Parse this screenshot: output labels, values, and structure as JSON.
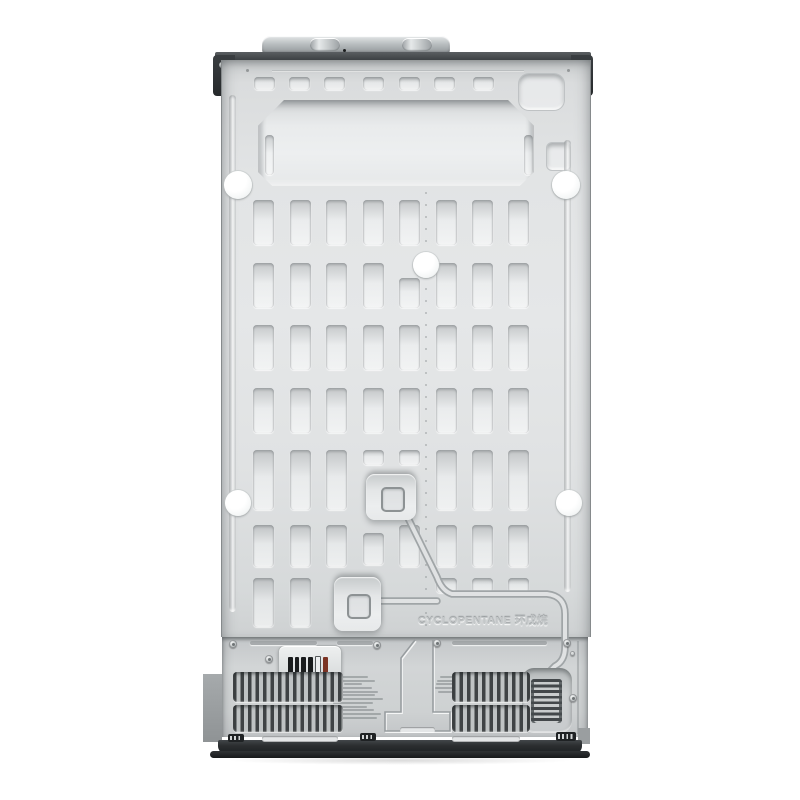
{
  "product": {
    "description": "Rear view photo of a side-by-side refrigerator back panel",
    "embossed_text": "CYCLOPENTANE 环戊烷"
  },
  "colors": {
    "background": "#ffffff",
    "panel_gray": "#e2e4e5",
    "bottom_panel_gray": "#ced1d2",
    "top_bar_dark": "#3c4043",
    "bracket_dark": "#26292b",
    "base_black": "#1d2022",
    "plug_white": "#ffffff",
    "grille_dark": "#3f4345",
    "label_bar_black": "#1a1c1d",
    "label_bar_red": "#7c3424"
  },
  "decor": {
    "top_slots": {
      "y": 77,
      "h": 13,
      "w": 21,
      "xs": [
        253,
        288,
        323,
        362,
        398,
        433,
        472
      ]
    },
    "vent_grid": {
      "xs": [
        252,
        289,
        325,
        362,
        398,
        435,
        471,
        507
      ],
      "w": 21,
      "variants": {
        "s": {
          "dy": 0,
          "h": 15
        },
        "l": {
          "dy": 15,
          "h": 30
        },
        "m": {
          "dy": 8,
          "h": 32
        }
      },
      "rows": [
        {
          "y": 200,
          "h": 45,
          "cols": [
            1,
            1,
            1,
            1,
            1,
            1,
            1,
            1
          ]
        },
        {
          "y": 263,
          "h": 45,
          "cols": [
            1,
            1,
            1,
            1,
            "l",
            1,
            1,
            1
          ]
        },
        {
          "y": 325,
          "h": 45,
          "cols": [
            1,
            1,
            1,
            1,
            1,
            1,
            1,
            1
          ]
        },
        {
          "y": 388,
          "h": 45,
          "cols": [
            1,
            1,
            1,
            1,
            1,
            1,
            1,
            1
          ]
        },
        {
          "y": 450,
          "h": 60,
          "cols": [
            1,
            1,
            1,
            "s",
            "s",
            1,
            1,
            1
          ]
        },
        {
          "y": 525,
          "h": 42,
          "cols": [
            1,
            1,
            1,
            "m",
            1,
            1,
            1,
            1
          ]
        },
        {
          "y": 578,
          "h": 49,
          "cols": [
            1,
            1,
            0,
            0,
            0,
            "s",
            "s",
            "s"
          ]
        }
      ]
    },
    "recess_inner_slots": [
      [
        264,
        135,
        9,
        40
      ],
      [
        523,
        135,
        9,
        40
      ]
    ],
    "plugs": [
      [
        237,
        185,
        14
      ],
      [
        565,
        185,
        14
      ],
      [
        425,
        265,
        13
      ],
      [
        237,
        503,
        13
      ],
      [
        568,
        503,
        13
      ]
    ],
    "pinholes": [
      [
        245,
        69
      ],
      [
        566,
        69
      ]
    ],
    "rivets": {
      "x": 424,
      "y0": 192,
      "step": 12,
      "count": 37
    },
    "screws": [
      [
        233,
        644
      ],
      [
        269,
        659
      ],
      [
        377,
        645
      ],
      [
        437,
        643
      ],
      [
        567,
        643
      ],
      [
        573,
        698
      ]
    ],
    "small_holes": [
      [
        572,
        653
      ]
    ],
    "label_bars": [
      "#1a1c1d",
      "#1a1c1d",
      "#1a1c1d",
      "#1a1c1d",
      "#edeff0",
      "#7c3424"
    ],
    "grilles": [
      {
        "x": 233,
        "y": 672,
        "w": 110,
        "h": 30
      },
      {
        "x": 233,
        "y": 705,
        "w": 110,
        "h": 27
      },
      {
        "x": 452,
        "y": 672,
        "w": 78,
        "h": 30
      },
      {
        "x": 452,
        "y": 705,
        "w": 78,
        "h": 27
      }
    ],
    "top_edge_slots": [
      [
        250,
        641,
        67
      ],
      [
        337,
        641,
        36
      ],
      [
        452,
        641,
        95
      ]
    ],
    "bottom_edge_slots": [
      [
        262,
        736,
        76
      ],
      [
        452,
        736,
        68
      ],
      [
        400,
        727,
        35
      ]
    ],
    "connectors": [
      [
        228,
        734,
        16,
        8
      ],
      [
        360,
        733,
        16,
        8
      ],
      [
        556,
        732,
        20,
        9
      ]
    ],
    "fine_print_left": [
      30,
      44,
      18,
      38,
      50,
      44,
      56,
      40,
      28,
      42,
      54,
      48
    ],
    "fine_print_right": [
      18,
      24,
      26,
      28,
      22
    ]
  }
}
